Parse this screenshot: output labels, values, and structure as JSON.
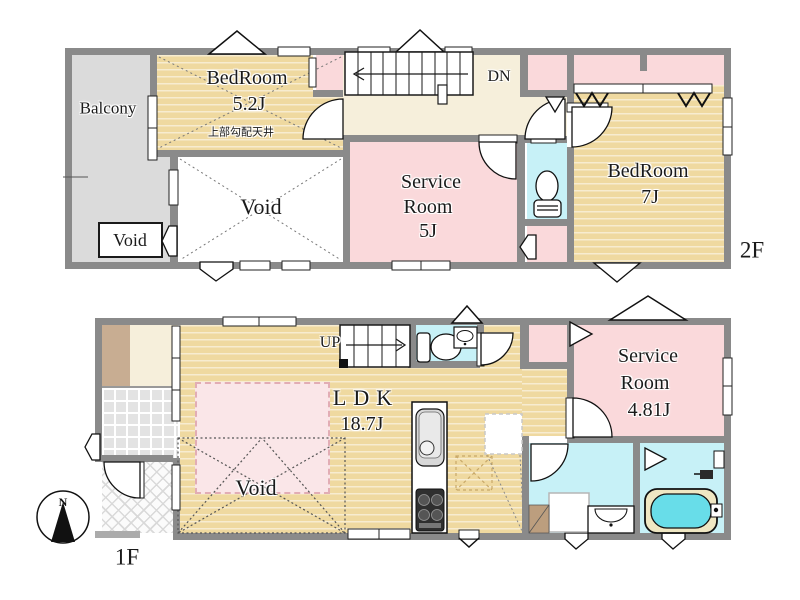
{
  "floor2": {
    "floor_label": "2F",
    "balcony_label": "Balcony",
    "bedroom52": {
      "name": "BedRoom",
      "size": "5.2J",
      "ceiling_note": "上部勾配天井"
    },
    "void_large_label": "Void",
    "void_small_label": "Void",
    "stairs_down_label": "DN",
    "service_room": {
      "line1": "Service",
      "line2": "Room",
      "size": "5J"
    },
    "bedroom7": {
      "name": "BedRoom",
      "size": "7J"
    }
  },
  "floor1": {
    "floor_label": "1F",
    "stairs_up_label": "UP",
    "ldk": {
      "name": "LDK",
      "size": "18.7J"
    },
    "void_label": "Void",
    "service_room": {
      "line1": "Service",
      "line2": "Room",
      "size": "4.81J"
    },
    "compass_north_label": "N"
  },
  "colors": {
    "wood_floor": "#EFD9A0",
    "room_pink": "#FAD9DB",
    "hall_cream": "#F6EFDB",
    "wet_cyan": "#C7F1F7",
    "balcony_gray": "#DBDBDB",
    "wall_gray": "#8A8A8A",
    "void_pink": "#FAE6E8",
    "bathtub_cyan": "#68DDE9"
  }
}
